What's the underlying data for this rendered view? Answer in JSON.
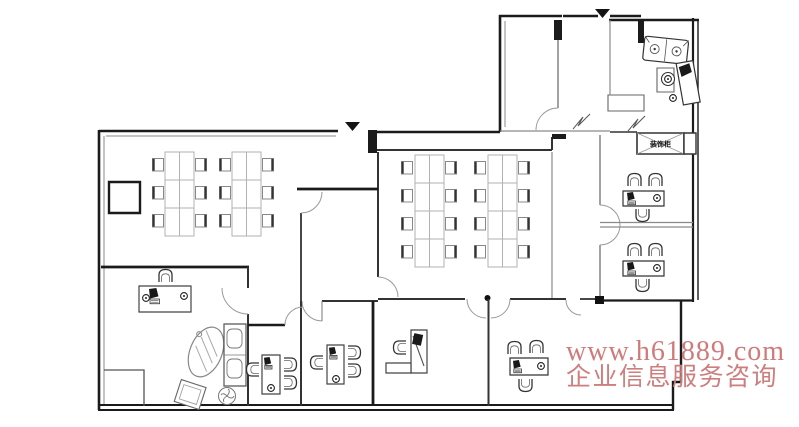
{
  "canvas": {
    "width": 799,
    "height": 427,
    "background": "#ffffff"
  },
  "watermark": {
    "line1": "www.h61889.com",
    "line2": "企业信息服务咨询",
    "line1_color": "#cf7b7b",
    "line2_color": "#cd7e7e"
  },
  "labels": {
    "cabinet": "装饰柜"
  },
  "markers": {
    "entrance_symbol": "▼",
    "entrance_count": 2
  },
  "palette": {
    "wall": "#1b1b1b",
    "partition": "#333333",
    "light_line": "#8a8a8a",
    "desk_line": "#aaaaaa",
    "furniture_line": "#555555"
  },
  "plan_summary": {
    "type": "office-floor-plan",
    "rooms": [
      {
        "name": "open-office-left",
        "desks": 12,
        "chairs": 12
      },
      {
        "name": "open-office-middle",
        "desks": 16,
        "chairs": 16
      },
      {
        "name": "meeting-room-small",
        "furniture": []
      },
      {
        "name": "entry-hall",
        "furniture": []
      },
      {
        "name": "lounge-top-right",
        "furniture": [
          "sofa",
          "coffee-table",
          "side-table",
          "wall-desk",
          "stools",
          "cabinet"
        ]
      },
      {
        "name": "private-office-right-1",
        "desks": 1,
        "chairs": 3
      },
      {
        "name": "private-office-right-2",
        "desks": 1,
        "chairs": 3
      },
      {
        "name": "manager-office",
        "furniture": [
          "desk",
          "chair",
          "oval-table",
          "sofa",
          "armchair",
          "fan"
        ]
      },
      {
        "name": "small-office-1",
        "desks": 1,
        "chairs": 3
      },
      {
        "name": "small-office-2",
        "desks": 1,
        "chairs": 3
      },
      {
        "name": "small-office-3",
        "desks": 1,
        "chairs": 1
      },
      {
        "name": "small-office-4",
        "desks": 1,
        "chairs": 3
      },
      {
        "name": "small-office-5",
        "furniture": []
      }
    ]
  }
}
